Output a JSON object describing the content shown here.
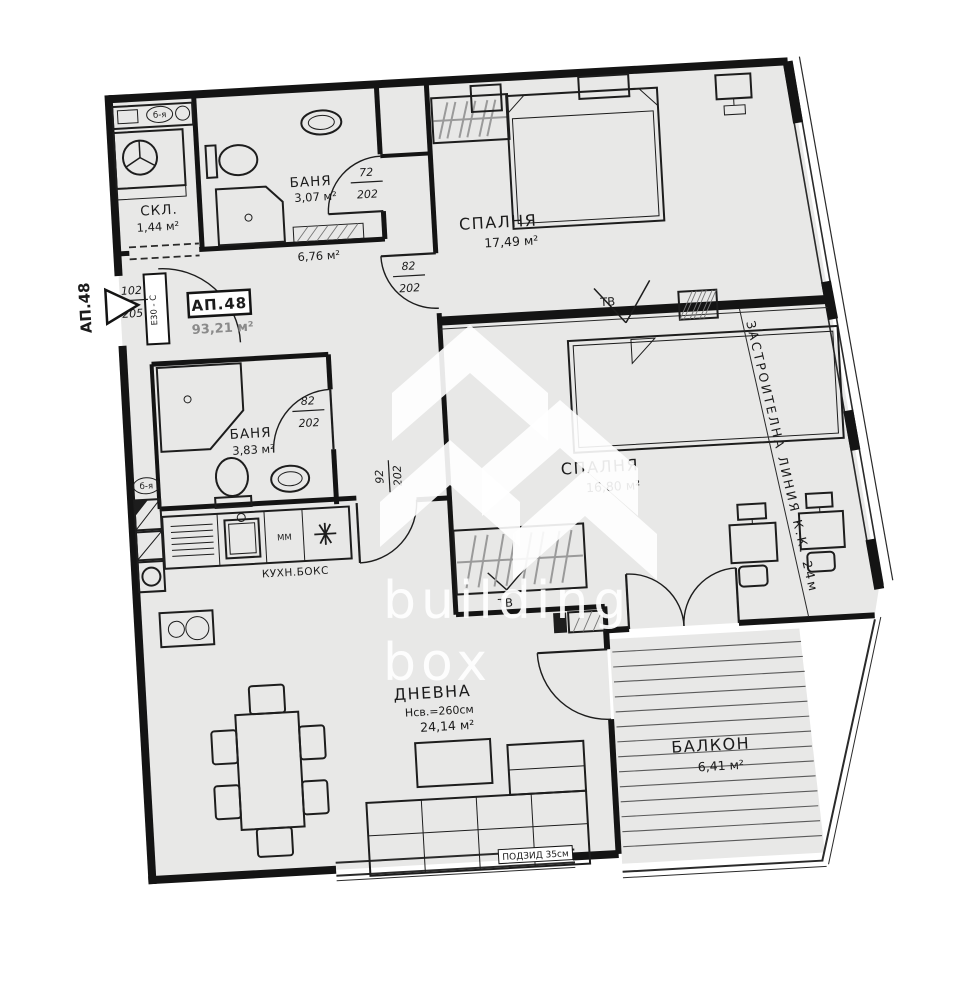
{
  "apartment": {
    "id": "АП.48",
    "total_area": "93,21 м²",
    "entry_marker": "АП.48"
  },
  "rooms": {
    "storage": {
      "name": "СКЛ.",
      "area": "1,44 м²"
    },
    "bath1": {
      "name": "БАНЯ",
      "area": "3,07 м²"
    },
    "corridor": {
      "area": "6,76 м²"
    },
    "bedroom1": {
      "name": "СПАЛНЯ",
      "area": "17,49 м²"
    },
    "bath2": {
      "name": "БАНЯ",
      "area": "3,83 м²"
    },
    "kitchen": {
      "name": "КУХН.БОКС"
    },
    "living": {
      "name": "ДНЕВНА",
      "clear_height": "Нсв.=260см",
      "area": "24,14 м²"
    },
    "bedroom2": {
      "name": "СПАЛНЯ",
      "area": "16,80 м²"
    },
    "balcony": {
      "name": "БАЛКОН",
      "area": "6,41 м²"
    }
  },
  "doors": {
    "bath1": {
      "w": "72",
      "h": "202"
    },
    "bedroom1": {
      "w": "82",
      "h": "202"
    },
    "bath2": {
      "w": "82",
      "h": "202"
    },
    "hall": {
      "w": "92",
      "h": "202"
    },
    "entrance": {
      "w": "102",
      "h": "205",
      "rating": "Е30 - С"
    }
  },
  "annotations": {
    "tv": "ТВ",
    "dishwasher": "ММ",
    "shaft": "б-я",
    "building_line": "ЗАСТРОИТЕЛНА ЛИНИЯ К.К. 24м",
    "podzid": "ПОДЗИД 35см"
  },
  "watermark": {
    "line1": "building",
    "line2": "box"
  },
  "colors": {
    "floor": "#e8e8e7",
    "wall": "#141414",
    "hatch": "#9a9a9a"
  }
}
